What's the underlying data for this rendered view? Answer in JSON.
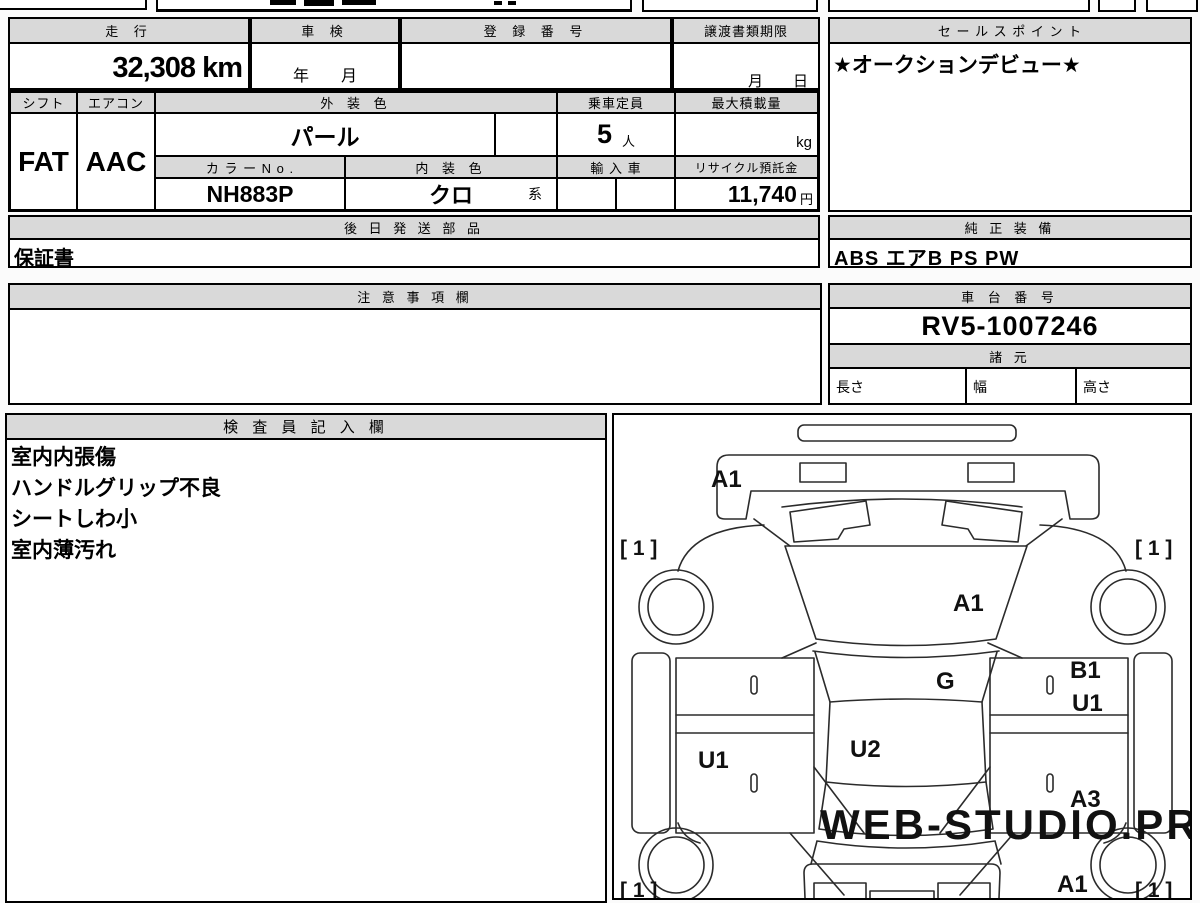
{
  "row1": {
    "mileage_label": "走 行",
    "mileage_value": "32,308 km",
    "shaken_label": "車 検",
    "shaken_value": "年　　月",
    "registration_label": "登 録 番 号",
    "registration_value": "",
    "transfer_label": "譲渡書類期限",
    "transfer_value": "月　　日",
    "sales_label": "セ ー ル ス ポ イ ン ト",
    "sales_value": "★オークションデビュー★"
  },
  "specs": {
    "shift_label": "シフト",
    "shift_value": "FAT",
    "aircon_label": "エアコン",
    "aircon_value": "AAC",
    "ext_color_label": "外 装 色",
    "ext_color_value": "パール",
    "color_no_label": "カ ラ ー N o .",
    "color_no_value": "NH883P",
    "int_color_label": "内 装 色",
    "int_color_value": "クロ",
    "int_color_suffix": "系",
    "capacity_label": "乗車定員",
    "capacity_value": "5",
    "capacity_unit": "人",
    "payload_label": "最大積載量",
    "payload_unit": "kg",
    "import_label": "輸 入 車",
    "recycle_label": "リサイクル預託金",
    "recycle_value": "11,740",
    "recycle_unit": "円"
  },
  "parts": {
    "label": "後 日 発 送 部 品",
    "value": "保証書"
  },
  "equipment": {
    "label": "純 正 装 備",
    "value": "ABS エアB PS PW"
  },
  "notes": {
    "label": "注 意 事 項 欄",
    "value": ""
  },
  "chassis": {
    "label": "車 台 番 号",
    "value": "RV5-1007246",
    "spec_label": "諸 元",
    "length_label": "長さ",
    "width_label": "幅",
    "height_label": "高さ"
  },
  "inspector": {
    "label": "検 査 員 記 入 欄",
    "lines": [
      "室内内張傷",
      "ハンドルグリップ不良",
      "シートしわ小",
      "室内薄汚れ"
    ]
  },
  "diagram": {
    "front_panel": "A1",
    "windshield": "A1",
    "cowl": "G",
    "roof": "U2",
    "left_door": "U1",
    "right_door_top": "B1",
    "right_door_upper": "U1",
    "right_door_lower": "A3",
    "rear_panel": "A1",
    "tire_front_left": "[ 1 ]",
    "tire_front_right": "[ 1 ]",
    "tire_rear_left": "[ 1 ]",
    "tire_rear_right": "[ 1 ]",
    "watermark": "WEB-STUDIO.PRO"
  }
}
